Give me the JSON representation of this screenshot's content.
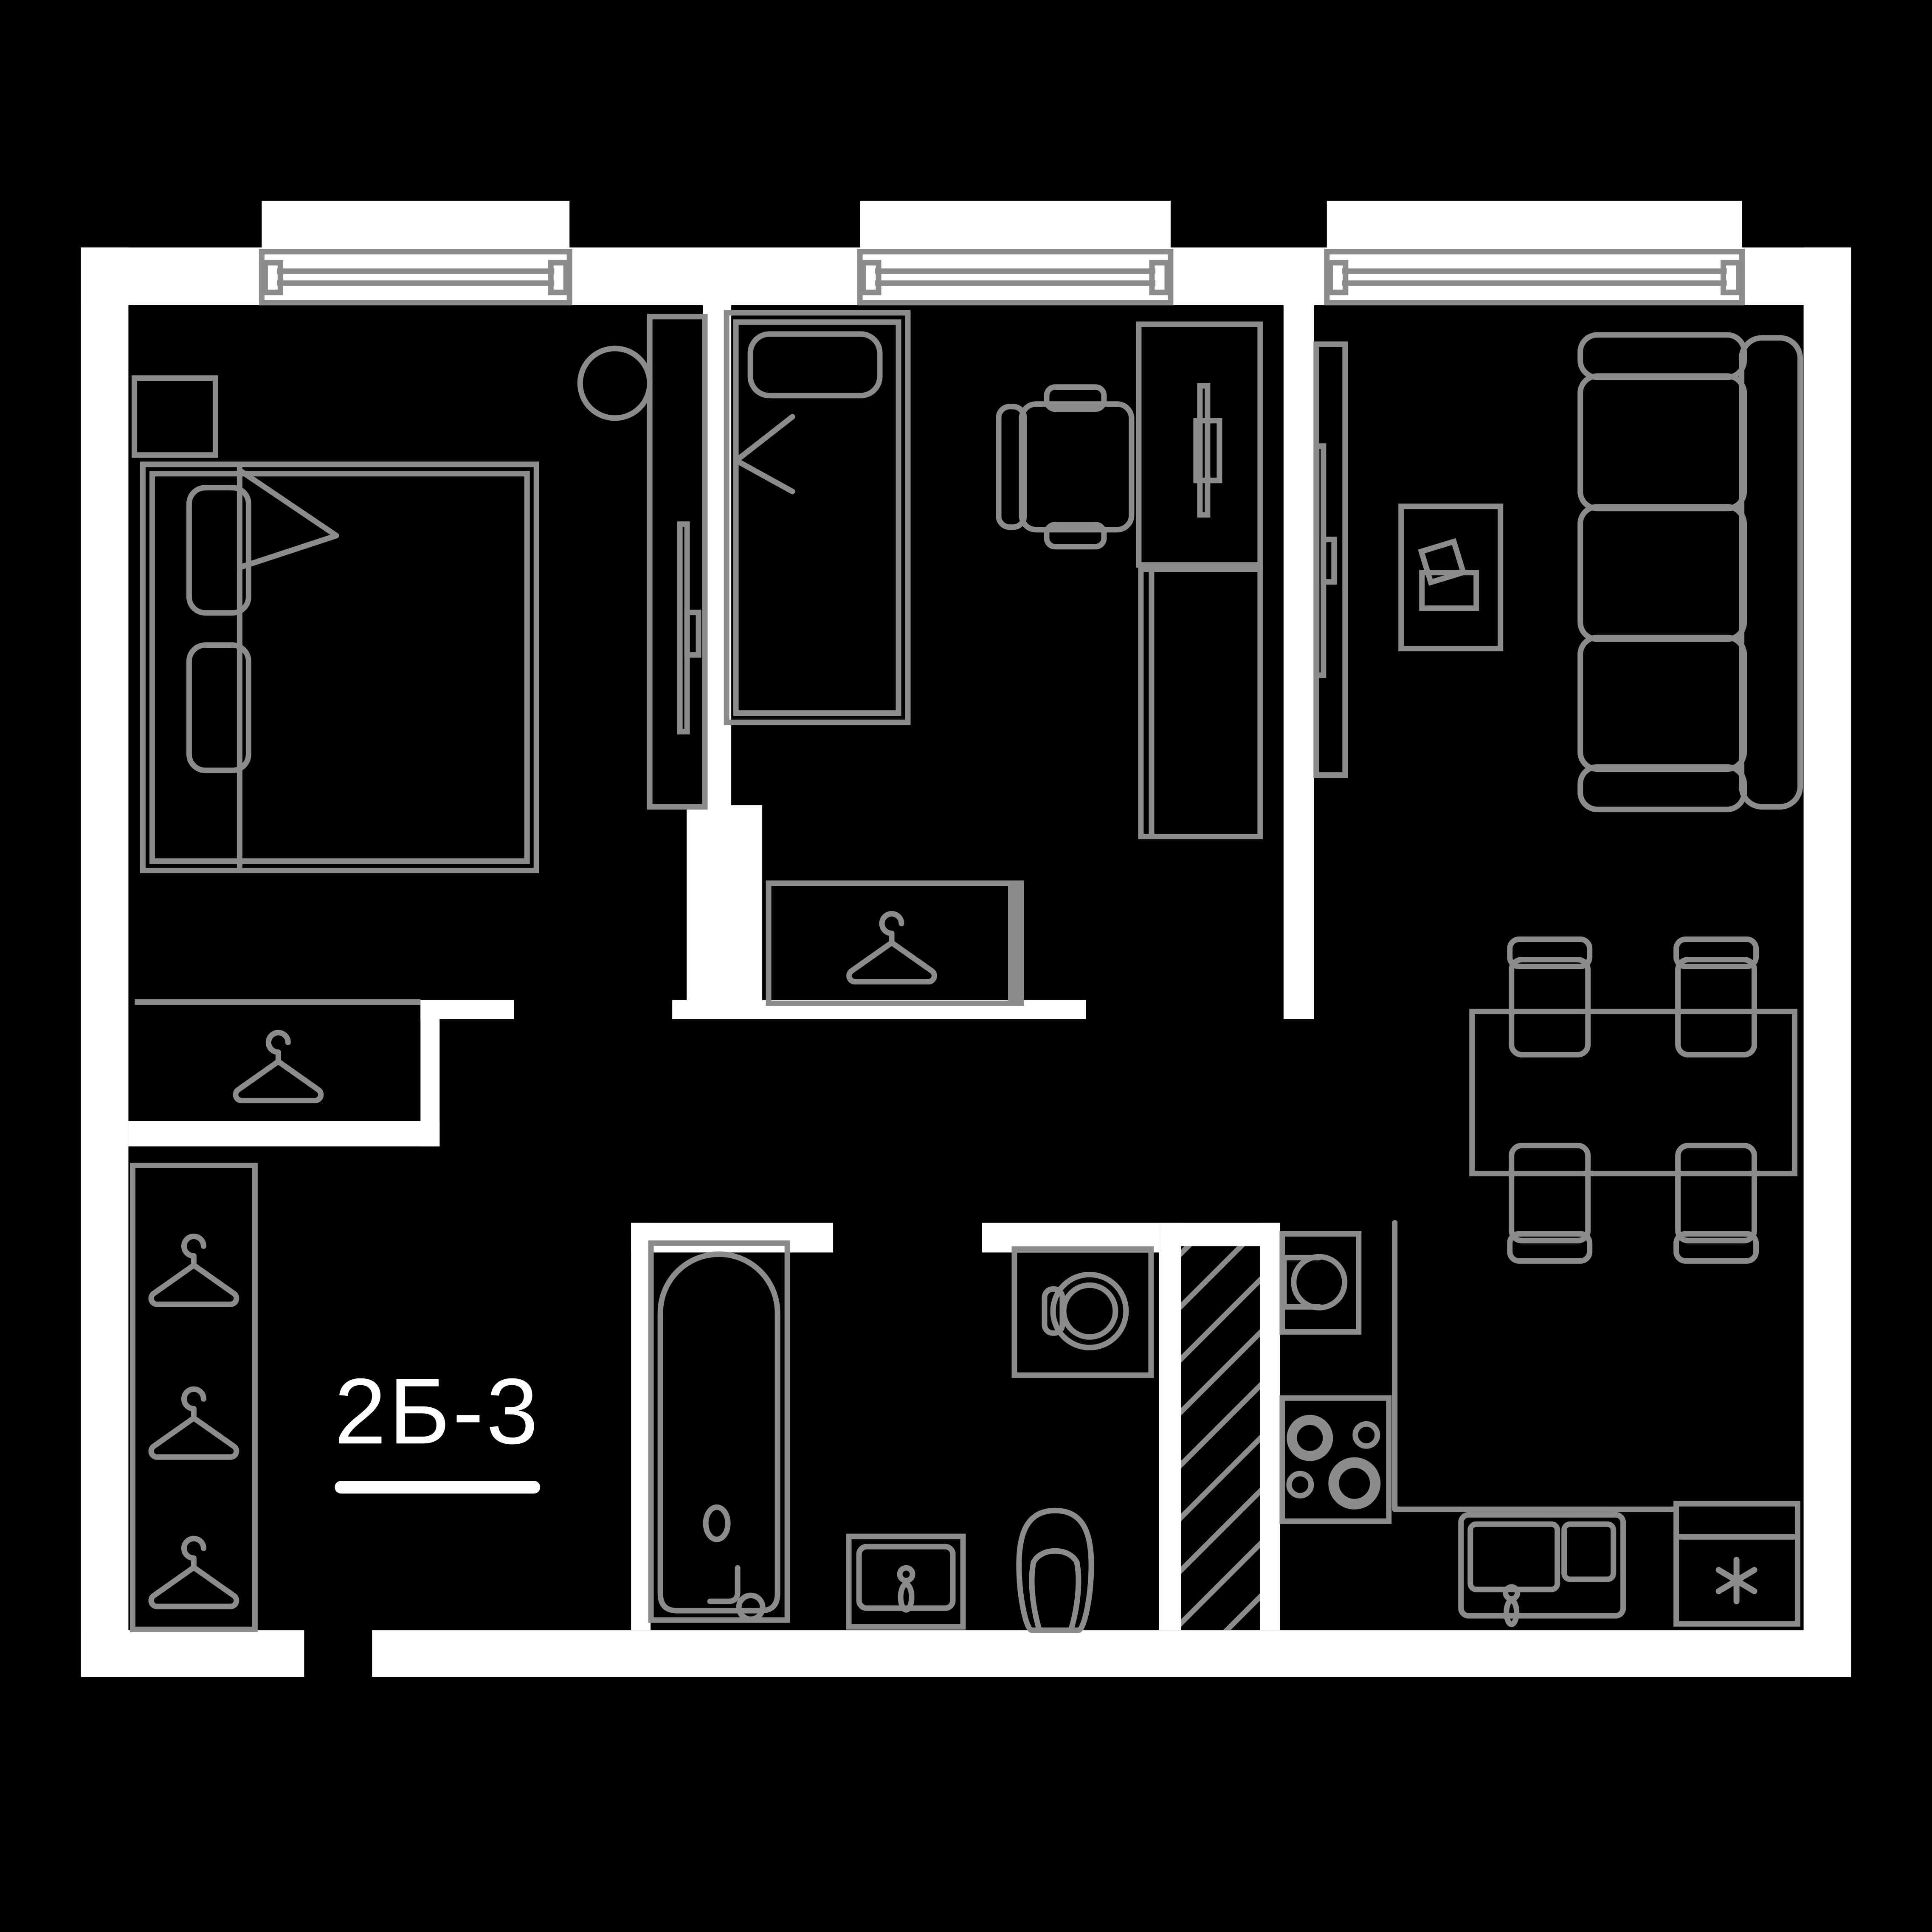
{
  "plan": {
    "unit_label": "2Б-3",
    "colors": {
      "background": "#000000",
      "wall": "#ffffff",
      "furniture_line": "#8c8c8c",
      "label_text": "#ffffff"
    },
    "windows": {
      "count": 3
    },
    "icons": [
      "hanger-icon",
      "double-bed-icon",
      "single-bed-icon",
      "nightstand-icon",
      "stool-icon",
      "wardrobe-icon",
      "tv-icon",
      "desk-icon",
      "desk-chair-icon",
      "cabinet-icon",
      "sofa-icon",
      "coffee-table-icon",
      "laptop-icon",
      "dining-table-icon",
      "dining-chair-icon",
      "bathtub-icon",
      "washbasin-icon",
      "toilet-icon",
      "washing-machine-icon",
      "duct-hatch-icon",
      "kitchen-sink-icon",
      "hob-icon",
      "sink-cabinet-icon",
      "fridge-asterisk-icon"
    ]
  }
}
